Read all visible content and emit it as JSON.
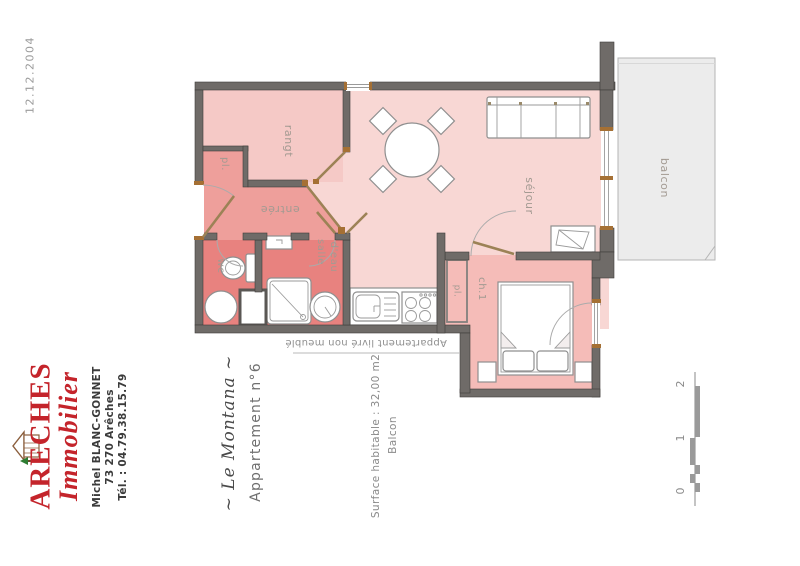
{
  "header": {
    "date": "12.12.2004"
  },
  "agency": {
    "name_top": "ARECHES",
    "name_bottom": "Immobilier",
    "brand_color": "#c4242b",
    "contact": [
      "Michel BLANC-GONNET",
      "73 270 Arêches",
      "Tél. : 04.79.38.15.79"
    ]
  },
  "property": {
    "residence": "~ Le Montana ~",
    "apartment": "Appartement n°6",
    "surface": "Surface habitable : 32,00 m2",
    "surface_extra": "Balcon"
  },
  "plan": {
    "note": "Appartement livré non meublé",
    "rooms": {
      "rangt": "rangt",
      "pl_entree": "pl.",
      "entree": "entrée",
      "wc": "wc",
      "salle": "salle",
      "deau": "d'eau",
      "sejour": "séjour",
      "ch1": "ch.1",
      "pl_ch1": "pl.",
      "balcon": "balcon"
    },
    "scale": {
      "s0": "0",
      "s1": "1",
      "s2": "2"
    },
    "colors": {
      "wall": "#6f6b68",
      "sejour_fill": "#f8d7d4",
      "rangt_fill": "#f5c9c6",
      "entree_fill": "#ee9f9b",
      "wet_fill": "#e8827f",
      "ch1_fill": "#f5bcb8",
      "balcony_fill": "#ececec",
      "door_leaf": "#9c8256"
    }
  }
}
